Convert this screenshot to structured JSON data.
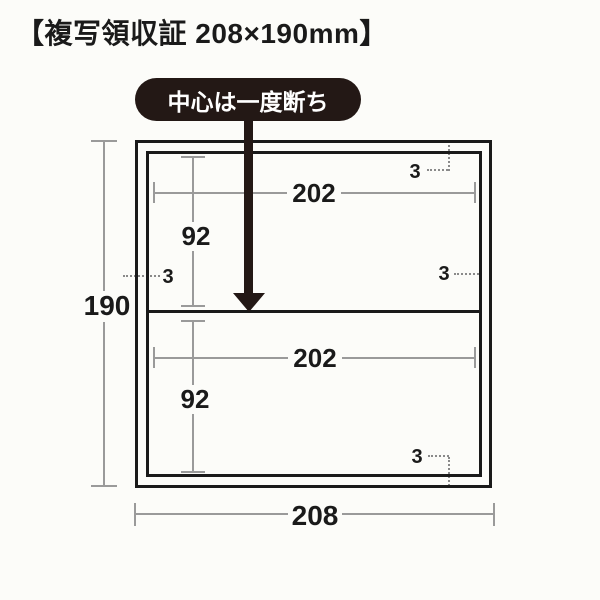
{
  "title": "【複写領収証 208×190mm】",
  "callout": {
    "label": "中心は一度断ち"
  },
  "dimensions": {
    "height": "190",
    "width": "208",
    "inner_width_top": "202",
    "inner_width_bottom": "202",
    "half_height_top": "92",
    "half_height_bottom": "92"
  },
  "margins": {
    "top_right": "3",
    "mid_left": "3",
    "mid_right": "3",
    "bottom_right": "3"
  },
  "colors": {
    "line": "#1a1a1a",
    "dim_line": "#9a9a9a",
    "dotted_line": "#8a8a8a",
    "callout_bg": "#231815",
    "callout_text": "#ffffff",
    "background": "#fcfcf9"
  }
}
